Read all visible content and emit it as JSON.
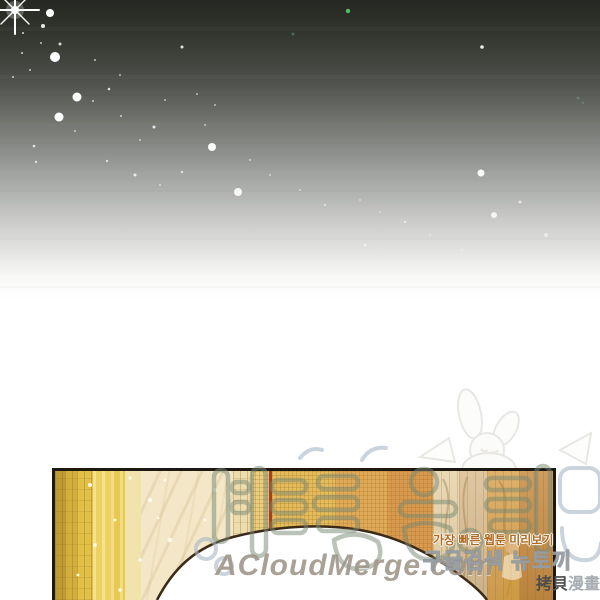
{
  "scene": {
    "description_label": "webtoon panel: starry night sky fading to white above a golden archway",
    "sky": {
      "bright_star": {
        "x": 15,
        "y": 10,
        "size": 40,
        "color": "#ffffff"
      },
      "stars": [
        {
          "x": 50,
          "y": 13,
          "r": 4,
          "o": 1
        },
        {
          "x": 43,
          "y": 26,
          "r": 2,
          "o": 0.9
        },
        {
          "x": 23,
          "y": 33,
          "r": 1,
          "o": 0.8
        },
        {
          "x": 60,
          "y": 44,
          "r": 1.5,
          "o": 0.8
        },
        {
          "x": 41,
          "y": 43,
          "r": 1,
          "o": 0.7
        },
        {
          "x": 22,
          "y": 53,
          "r": 1,
          "o": 0.8
        },
        {
          "x": 55,
          "y": 57,
          "r": 5,
          "o": 1
        },
        {
          "x": 30,
          "y": 70,
          "r": 1,
          "o": 0.7
        },
        {
          "x": 13,
          "y": 77,
          "r": 1,
          "o": 0.7
        },
        {
          "x": 77,
          "y": 97,
          "r": 4.5,
          "o": 1
        },
        {
          "x": 109,
          "y": 89,
          "r": 1.3,
          "o": 0.8
        },
        {
          "x": 93,
          "y": 101,
          "r": 1,
          "o": 0.7
        },
        {
          "x": 59,
          "y": 117,
          "r": 4.5,
          "o": 1
        },
        {
          "x": 121,
          "y": 116,
          "r": 1,
          "o": 0.7
        },
        {
          "x": 75,
          "y": 131,
          "r": 1,
          "o": 0.6
        },
        {
          "x": 34,
          "y": 146,
          "r": 1.3,
          "o": 0.8
        },
        {
          "x": 36,
          "y": 162,
          "r": 1.2,
          "o": 0.7
        },
        {
          "x": 95,
          "y": 60,
          "r": 1,
          "o": 0.7
        },
        {
          "x": 120,
          "y": 75,
          "r": 1,
          "o": 0.6
        },
        {
          "x": 154,
          "y": 127,
          "r": 1.5,
          "o": 0.8
        },
        {
          "x": 140,
          "y": 140,
          "r": 1,
          "o": 0.6
        },
        {
          "x": 182,
          "y": 47,
          "r": 1.5,
          "o": 0.85
        },
        {
          "x": 165,
          "y": 100,
          "r": 1,
          "o": 0.6
        },
        {
          "x": 197,
          "y": 94,
          "r": 1,
          "o": 0.6
        },
        {
          "x": 215,
          "y": 105,
          "r": 1,
          "o": 0.6
        },
        {
          "x": 182,
          "y": 172,
          "r": 1.2,
          "o": 0.7
        },
        {
          "x": 107,
          "y": 161,
          "r": 1.2,
          "o": 0.7
        },
        {
          "x": 135,
          "y": 175,
          "r": 1.5,
          "o": 0.8
        },
        {
          "x": 160,
          "y": 185,
          "r": 1,
          "o": 0.6
        },
        {
          "x": 212,
          "y": 147,
          "r": 4,
          "o": 0.95
        },
        {
          "x": 238,
          "y": 192,
          "r": 4,
          "o": 0.9
        },
        {
          "x": 250,
          "y": 160,
          "r": 1,
          "o": 0.6
        },
        {
          "x": 270,
          "y": 175,
          "r": 1,
          "o": 0.55
        },
        {
          "x": 205,
          "y": 125,
          "r": 1,
          "o": 0.55
        },
        {
          "x": 300,
          "y": 190,
          "r": 1,
          "o": 0.5
        },
        {
          "x": 325,
          "y": 205,
          "r": 1.2,
          "o": 0.5
        },
        {
          "x": 360,
          "y": 200,
          "r": 1,
          "o": 0.45
        },
        {
          "x": 380,
          "y": 212,
          "r": 1,
          "o": 0.45
        },
        {
          "x": 405,
          "y": 222,
          "r": 1.2,
          "o": 0.5
        },
        {
          "x": 430,
          "y": 235,
          "r": 1,
          "o": 0.4
        },
        {
          "x": 462,
          "y": 250,
          "r": 1,
          "o": 0.4
        },
        {
          "x": 482,
          "y": 47,
          "r": 1.8,
          "o": 0.9
        },
        {
          "x": 481,
          "y": 173,
          "r": 3.5,
          "o": 0.95
        },
        {
          "x": 494,
          "y": 215,
          "r": 3,
          "o": 0.8
        },
        {
          "x": 520,
          "y": 202,
          "r": 1.5,
          "o": 0.6
        },
        {
          "x": 546,
          "y": 235,
          "r": 2,
          "o": 0.5
        },
        {
          "x": 365,
          "y": 245,
          "r": 1.5,
          "o": 0.45
        },
        {
          "x": 348,
          "y": 11,
          "r": 2.2,
          "o": 1,
          "c": "#54bb64"
        },
        {
          "x": 293,
          "y": 34,
          "r": 1.5,
          "o": 0.8,
          "c": "#4a7a55"
        },
        {
          "x": 578,
          "y": 98,
          "r": 1.3,
          "o": 0.6,
          "c": "#7a9a85"
        },
        {
          "x": 583,
          "y": 103,
          "r": 1,
          "o": 0.5,
          "c": "#8aa592"
        }
      ]
    },
    "panel": {
      "border_color": "#1e1812",
      "bands": [
        {
          "x": 0,
          "w": 10,
          "c": "#bf9b35",
          "tex": "planks"
        },
        {
          "x": 10,
          "w": 12,
          "c": "#d4ae3c",
          "tex": "planks"
        },
        {
          "x": 22,
          "w": 16,
          "c": "#e2bf45",
          "tex": "planks"
        },
        {
          "x": 38,
          "w": 18,
          "c": "#edd262",
          "tex": "streaks"
        },
        {
          "x": 56,
          "w": 14,
          "c": "#e7c850",
          "tex": "streaks"
        },
        {
          "x": 70,
          "w": 16,
          "c": "#f2e2ab",
          "tex": "none"
        },
        {
          "x": 86,
          "w": 92,
          "c": "#f3e7c7",
          "tex": "rays"
        },
        {
          "x": 178,
          "w": 18,
          "c": "#ecdcae",
          "tex": "planks"
        },
        {
          "x": 196,
          "w": 18,
          "c": "#e9cf80",
          "tex": "grid"
        },
        {
          "x": 214,
          "w": 3,
          "c": "#a8401f",
          "tex": "none"
        },
        {
          "x": 217,
          "w": 63,
          "c": "#e4bc5c",
          "tex": "grid"
        },
        {
          "x": 280,
          "w": 52,
          "c": "#e0ab58",
          "tex": "grid"
        },
        {
          "x": 332,
          "w": 46,
          "c": "#d89a4e",
          "tex": "grid"
        },
        {
          "x": 378,
          "w": 26,
          "c": "#e6d2a8",
          "tex": "cols"
        },
        {
          "x": 404,
          "w": 28,
          "c": "#d9bd92",
          "tex": "cols"
        },
        {
          "x": 432,
          "w": 32,
          "c": "#d9a452",
          "tex": "cols"
        },
        {
          "x": 464,
          "w": 34,
          "c": "#c68c42",
          "tex": "cols"
        }
      ],
      "sparkles": [
        {
          "x": 90,
          "y": 485,
          "r": 2
        },
        {
          "x": 130,
          "y": 478,
          "r": 1.6
        },
        {
          "x": 150,
          "y": 500,
          "r": 2.2
        },
        {
          "x": 115,
          "y": 520,
          "r": 1.5
        },
        {
          "x": 95,
          "y": 545,
          "r": 2
        },
        {
          "x": 140,
          "y": 560,
          "r": 1.8
        },
        {
          "x": 170,
          "y": 540,
          "r": 2.4
        },
        {
          "x": 185,
          "y": 575,
          "r": 1.6
        },
        {
          "x": 205,
          "y": 520,
          "r": 1.5
        },
        {
          "x": 215,
          "y": 490,
          "r": 2
        },
        {
          "x": 165,
          "y": 480,
          "r": 1.4
        },
        {
          "x": 225,
          "y": 555,
          "r": 1.6
        },
        {
          "x": 120,
          "y": 590,
          "r": 1.8
        },
        {
          "x": 78,
          "y": 575,
          "r": 1.4
        },
        {
          "x": 158,
          "y": 518,
          "r": 1.3
        },
        {
          "x": 198,
          "y": 548,
          "r": 1.3
        }
      ]
    },
    "watermarks": {
      "acloudmerge": "ACloudMerge.com",
      "korean_line1": "가장 빠른 웹툰 미리보기",
      "korean_line2": "구글검색 뉴토끼",
      "cjk_stamp_dark": "拷貝",
      "cjk_stamp_light": "漫畫"
    }
  }
}
